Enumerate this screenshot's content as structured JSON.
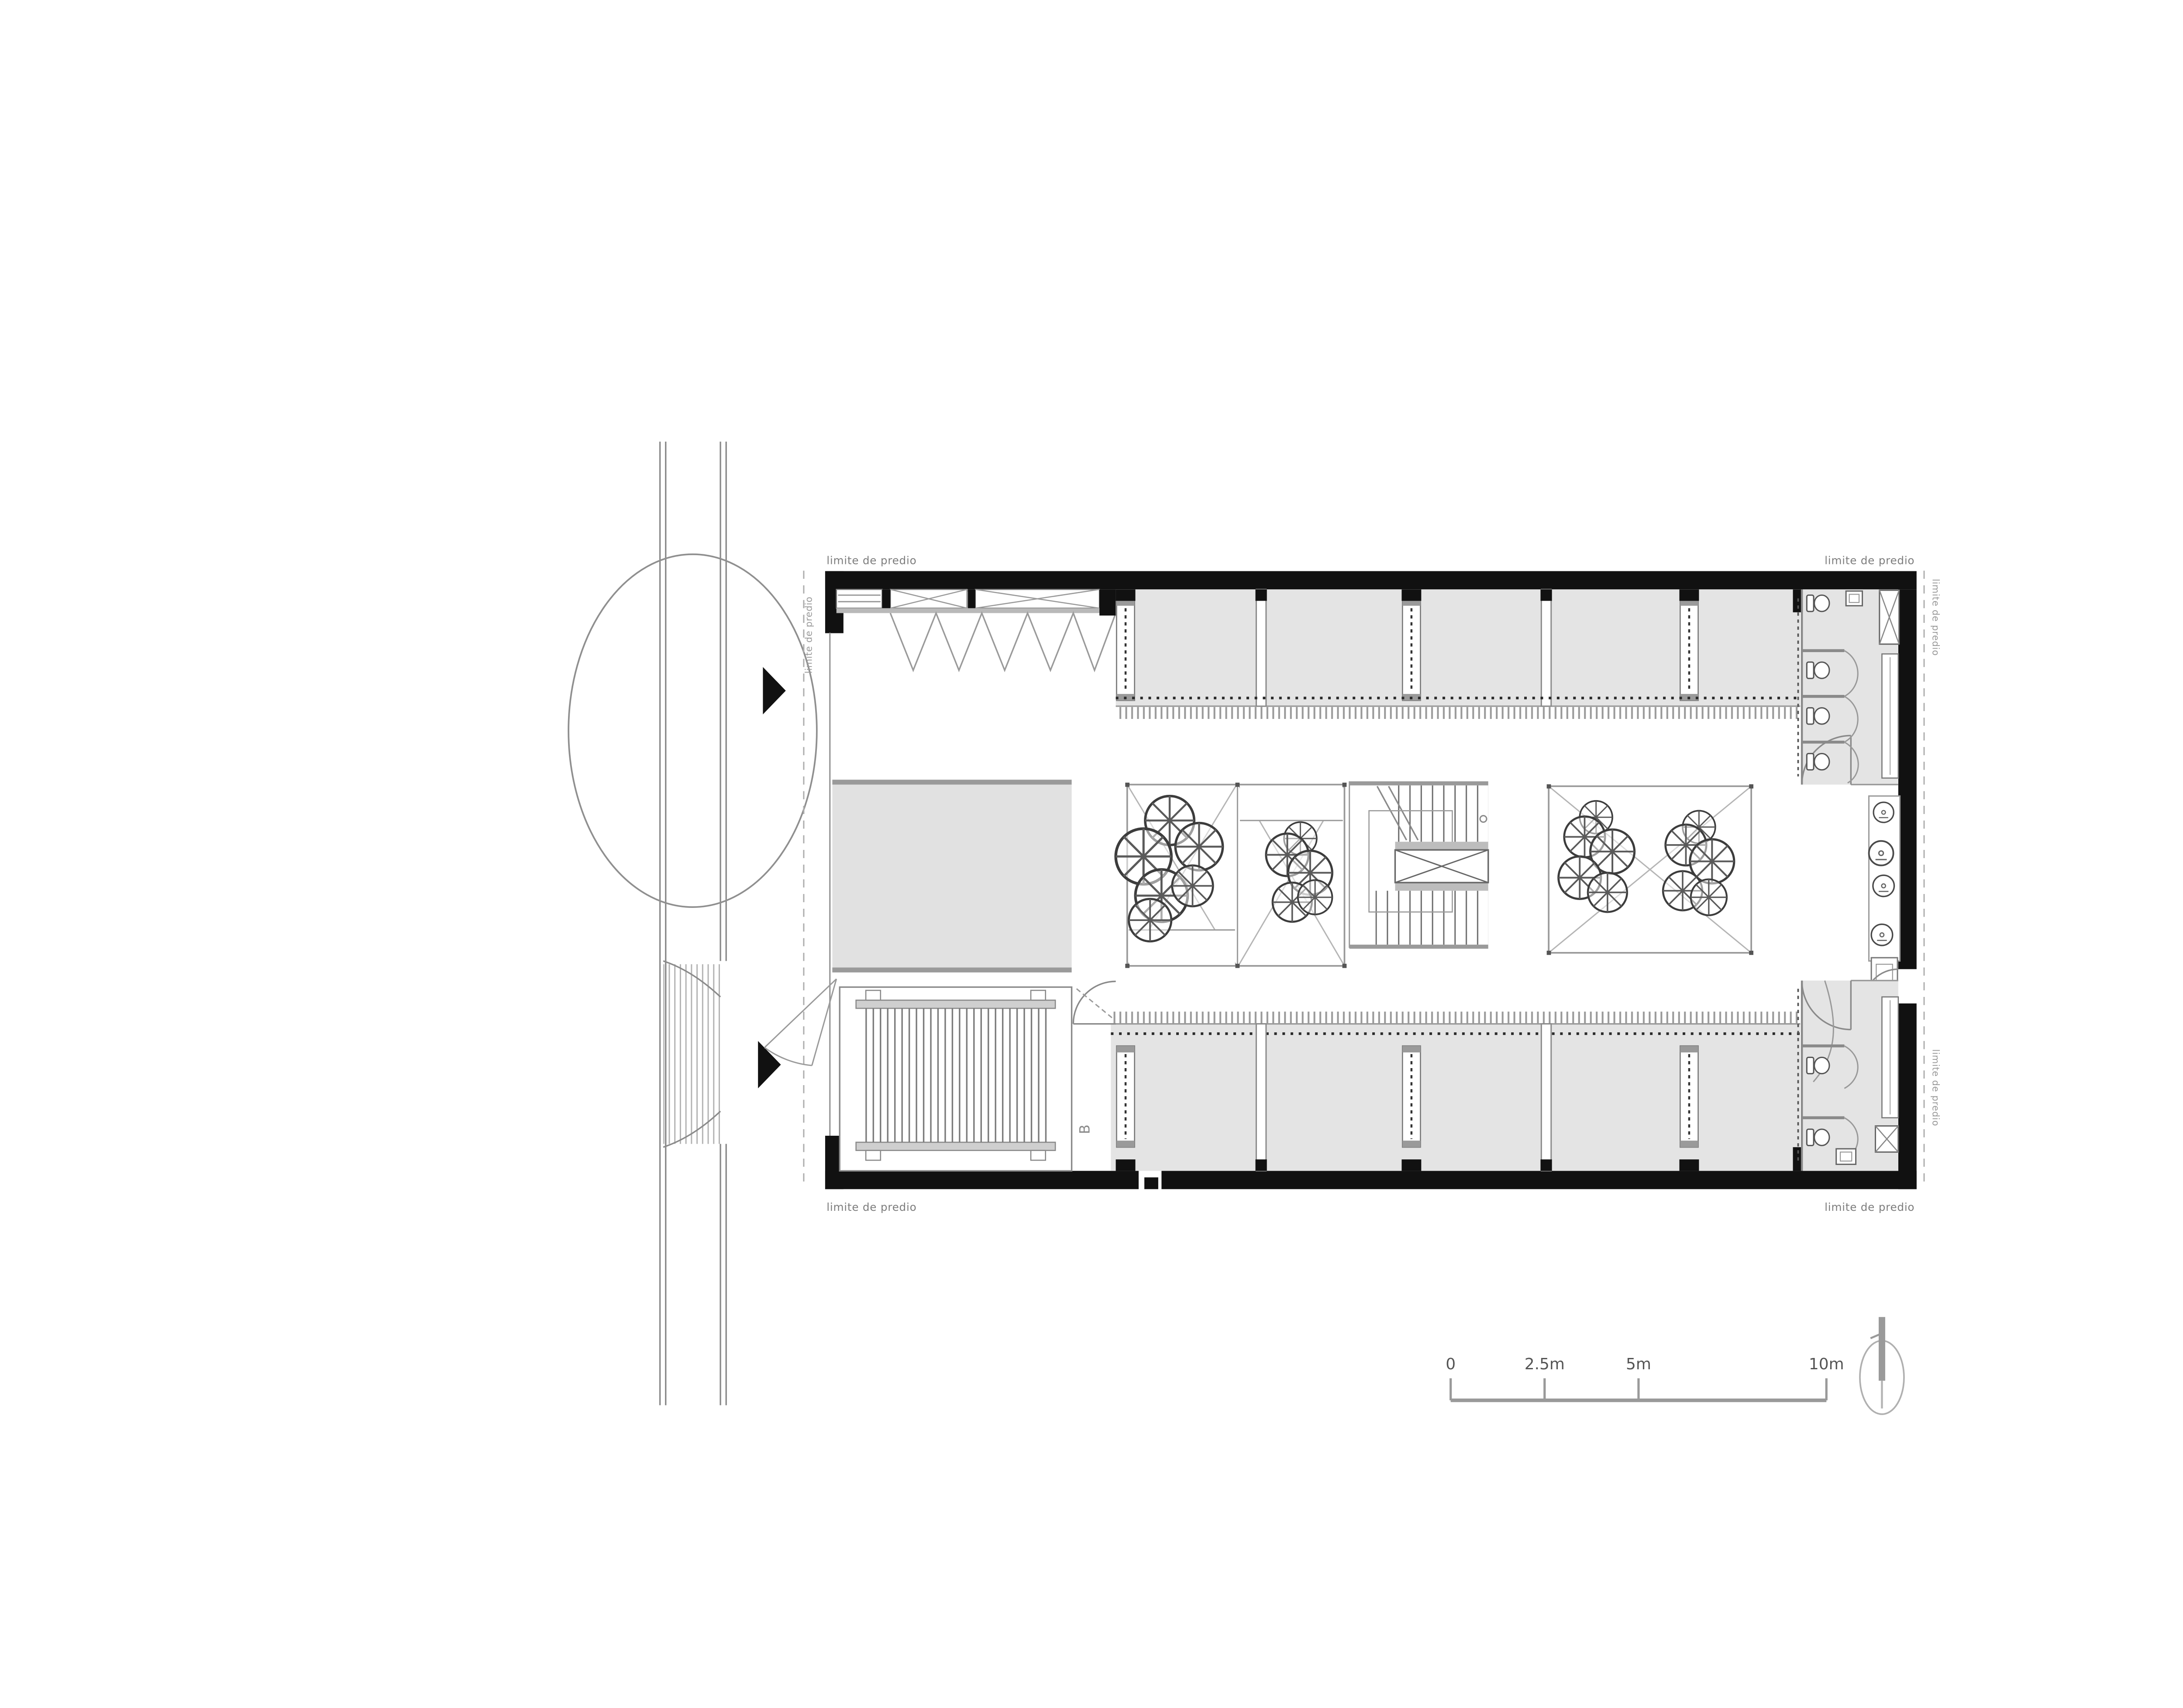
{
  "annotations": {
    "property_line": "limite de predio",
    "section_label": "B"
  },
  "scale_bar": {
    "tick_labels": [
      "0",
      "2.5m",
      "5m",
      "10m"
    ]
  },
  "north_arrow": {
    "icon": "north-arrow-icon"
  },
  "colors": {
    "wall_ink": "#111111",
    "room_fill": "#e4e4e4",
    "patio_fill": "#e1e1e1",
    "mid_gray": "#8a8a8a",
    "light_gray": "#b5b5b5",
    "label_gray": "#777777"
  }
}
